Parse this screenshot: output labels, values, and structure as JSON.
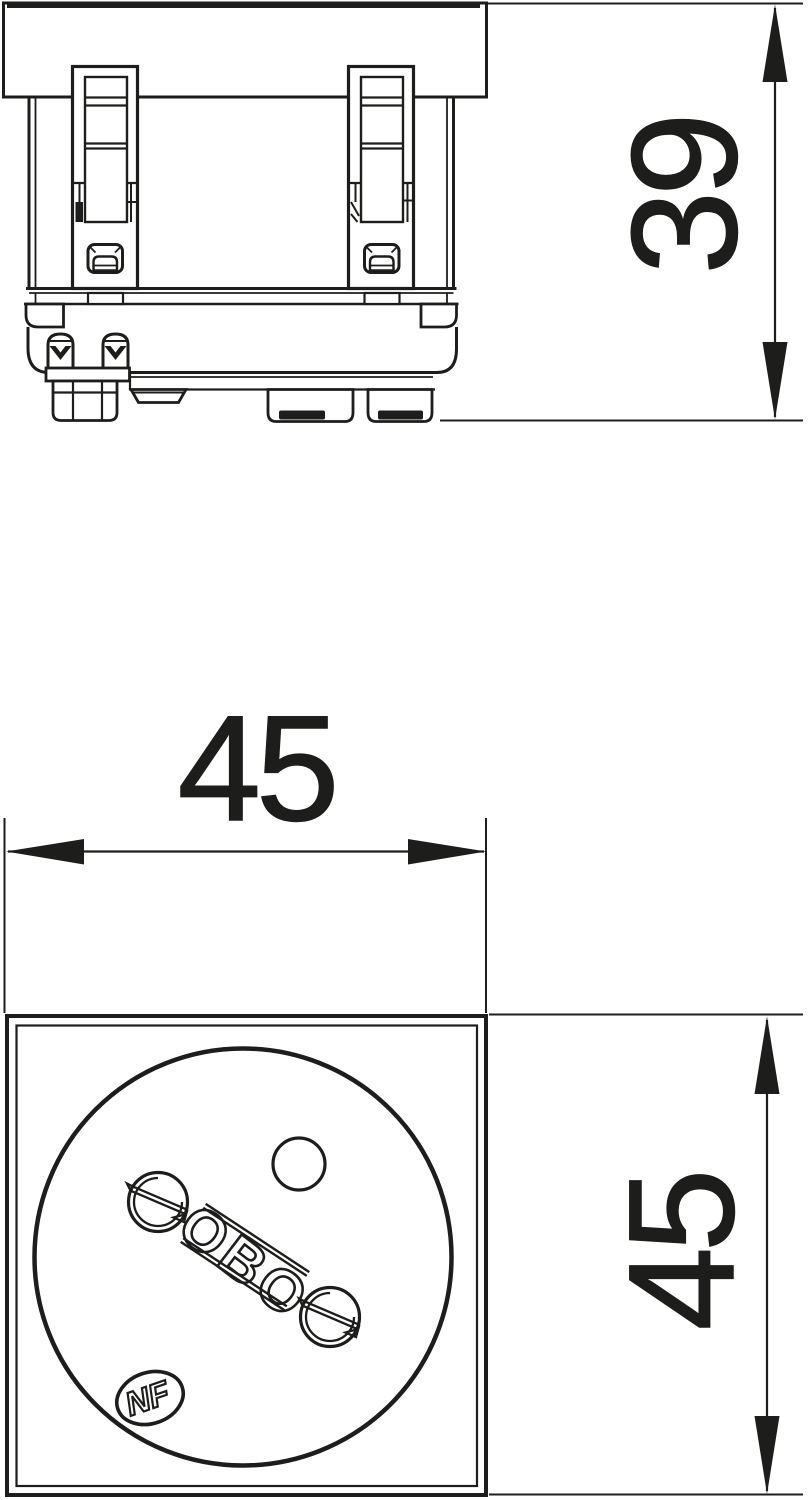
{
  "colors": {
    "line": "#1d1d1b",
    "background": "#ffffff"
  },
  "side_view": {
    "height_dimension": {
      "label": "39"
    }
  },
  "front_view": {
    "width_dimension": {
      "label": "45"
    },
    "height_dimension": {
      "label": "45"
    },
    "brand_marking": "OBO",
    "certification_marking": "NF"
  }
}
